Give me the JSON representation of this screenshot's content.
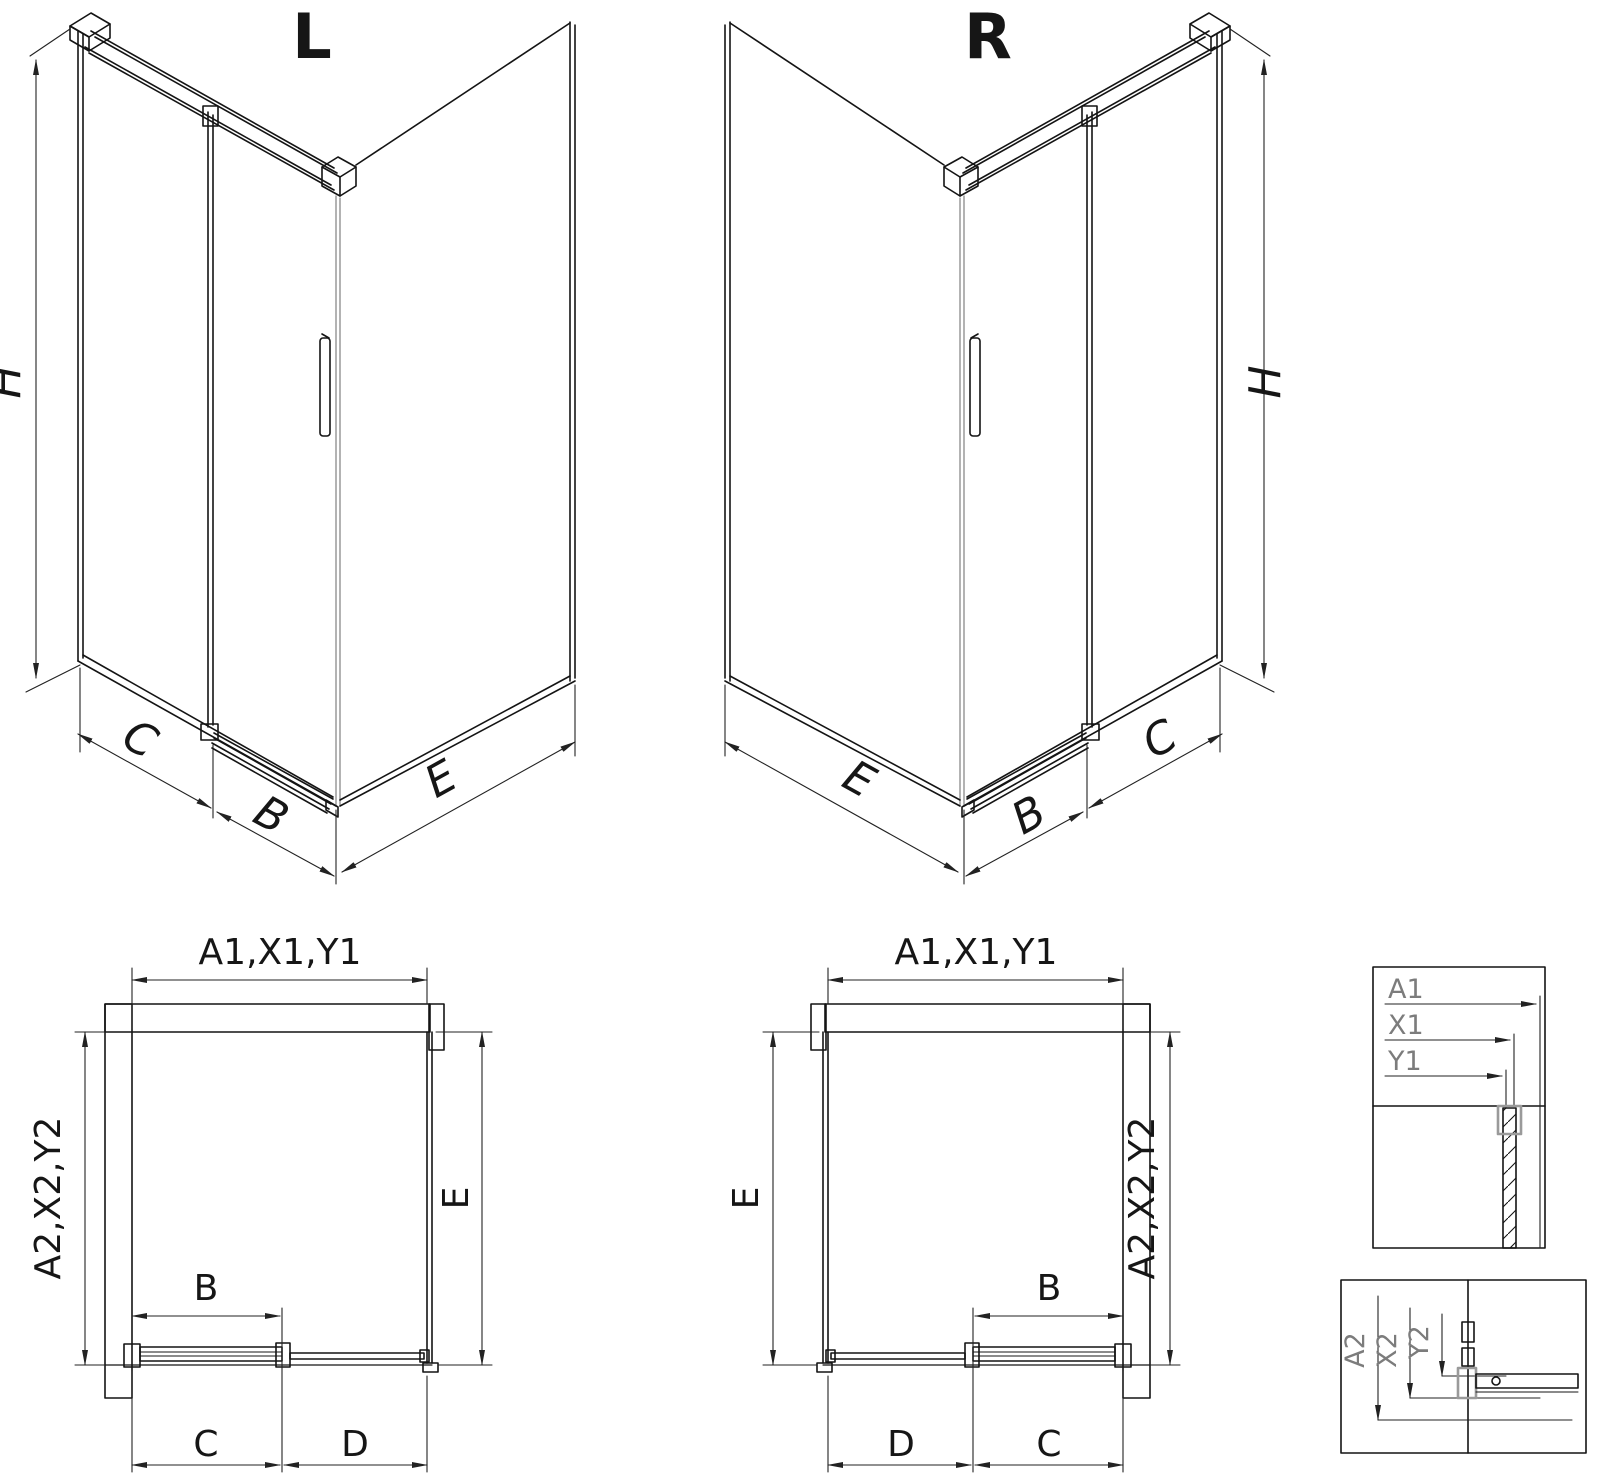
{
  "iso_left": {
    "title": "L",
    "labels": {
      "height": "H",
      "fixed_panel": "C",
      "door": "B",
      "side_panel": "E"
    }
  },
  "iso_right": {
    "title": "R",
    "labels": {
      "height": "H",
      "fixed_panel": "C",
      "door": "B",
      "side_panel": "E"
    }
  },
  "plan_left": {
    "dim_width_total": "A1,X1,Y1",
    "dim_depth_total": "A2,X2,Y2",
    "dim_door": "B",
    "dim_fixed": "C",
    "dim_opening": "D",
    "dim_side": "E"
  },
  "plan_right": {
    "dim_width_total": "A1,X1,Y1",
    "dim_depth_total": "A2,X2,Y2",
    "dim_door": "B",
    "dim_fixed": "C",
    "dim_opening": "D",
    "dim_side": "E"
  },
  "detail_width": {
    "label_a": "A1",
    "label_x": "X1",
    "label_y": "Y1"
  },
  "detail_depth": {
    "label_a": "A2",
    "label_x": "X2",
    "label_y": "Y2"
  },
  "colors": {
    "line": "#141414",
    "dim_line": "#222222",
    "gray_profile": "#8a8a8a",
    "detail_text": "#7c7c7c",
    "background": "#ffffff"
  }
}
